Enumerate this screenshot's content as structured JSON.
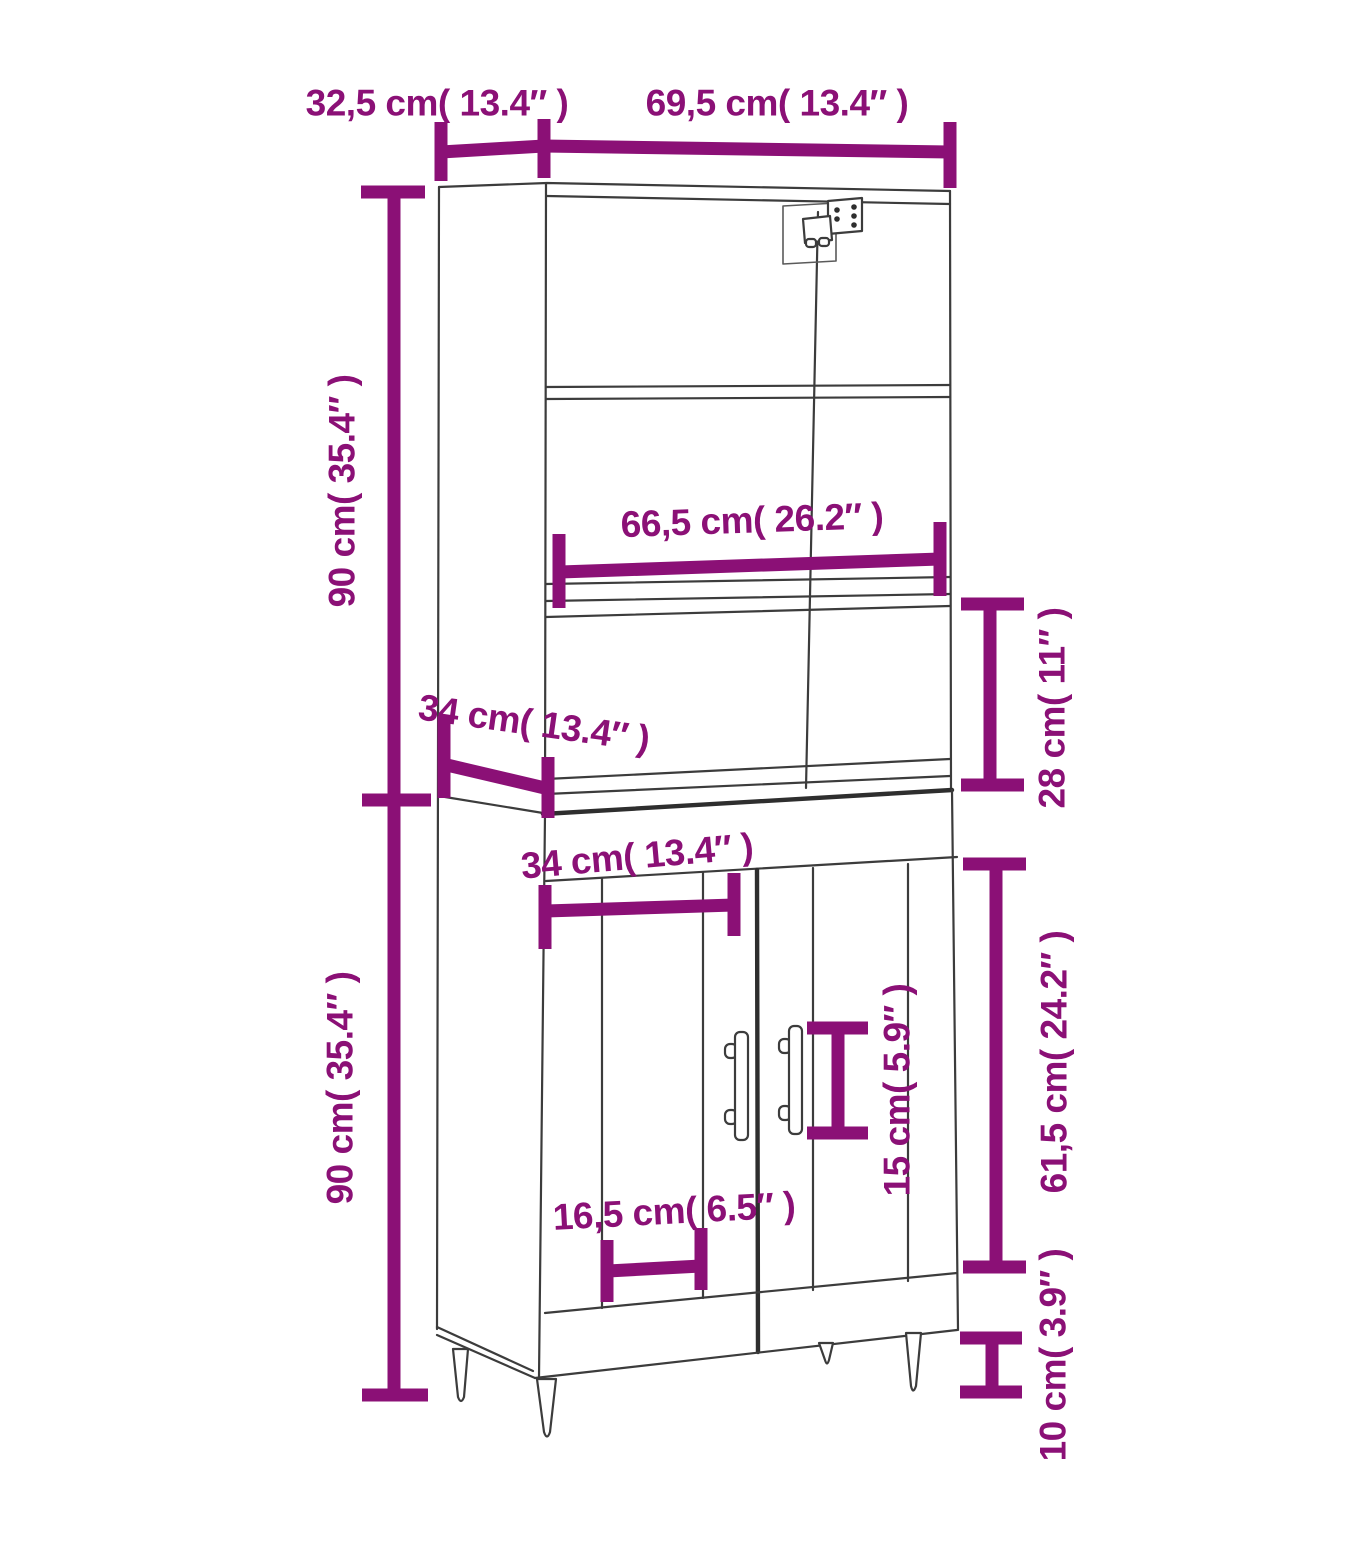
{
  "diagram": {
    "accent_color": "#8B1076",
    "line_color": "#3C3C3C",
    "labels": {
      "top_depth": "32,5 cm( 13.4″ )",
      "top_width": "69,5 cm( 13.4″ )",
      "upper_section_height": "90 cm( 35.4″ )",
      "shelf_width": "66,5 cm( 26.2″ )",
      "upper_depth": "34 cm( 13.4″ )",
      "shelf_gap_height": "28 cm( 11″ )",
      "lower_inner_width": "34 cm( 13.4″ )",
      "lower_section_height": "90 cm( 35.4″ )",
      "door_panel_width": "16,5 cm( 6.5″ )",
      "handle_height": "15 cm( 5.9″ )",
      "door_height": "61,5 cm( 24.2″ )",
      "leg_height": "10 cm( 3.9″ )"
    }
  }
}
